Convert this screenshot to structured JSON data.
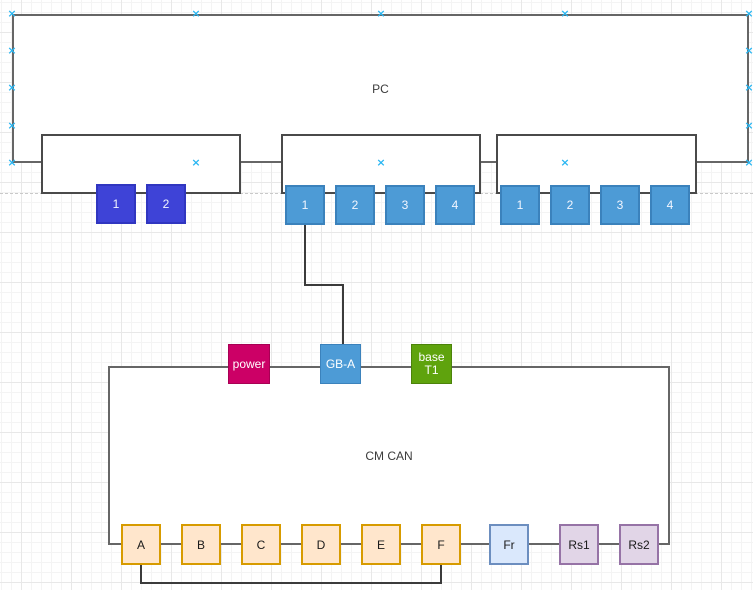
{
  "canvas": {
    "background_color": "#ffffff",
    "grid_minor_color": "#f4f4f4",
    "grid_major_color": "#e8e8e8",
    "page_break_color": "#c9c9c9",
    "connection_point_color": "#29b6f2",
    "connection_point_glyph": "×"
  },
  "pc_host": {
    "label": "PC",
    "border_color": "#666666",
    "nics": [
      {
        "name": "dual-port-nic",
        "port_fill": "#3e43d7",
        "port_border": "#3036c0",
        "ports": [
          "1",
          "2"
        ]
      },
      {
        "name": "quad-port-nic-1",
        "port_fill": "#4d9bd6",
        "port_border": "#3b82bc",
        "ports": [
          "1",
          "2",
          "3",
          "4"
        ]
      },
      {
        "name": "quad-port-nic-2",
        "port_fill": "#4d9bd6",
        "port_border": "#3b82bc",
        "ports": [
          "1",
          "2",
          "3",
          "4"
        ]
      }
    ]
  },
  "cm_device": {
    "label": "CM CAN",
    "border_color": "#666666",
    "top_modules": [
      {
        "label": "power",
        "fill": "#cc0066",
        "border": "#a80054"
      },
      {
        "label": "GB-A",
        "fill": "#4d9bd6",
        "border": "#3b82bc"
      },
      {
        "label_line1": "base",
        "label_line2": "T1",
        "fill": "#5fa30d",
        "border": "#4c830a"
      }
    ],
    "bottom_modules": [
      {
        "label": "A",
        "fill": "#ffe6cc",
        "border": "#d79b00"
      },
      {
        "label": "B",
        "fill": "#ffe6cc",
        "border": "#d79b00"
      },
      {
        "label": "C",
        "fill": "#ffe6cc",
        "border": "#d79b00"
      },
      {
        "label": "D",
        "fill": "#ffe6cc",
        "border": "#d79b00"
      },
      {
        "label": "E",
        "fill": "#ffe6cc",
        "border": "#d79b00"
      },
      {
        "label": "F",
        "fill": "#ffe6cc",
        "border": "#d79b00"
      },
      {
        "label": "Fr",
        "fill": "#dae8fc",
        "border": "#6c8ebf"
      },
      {
        "label": "Rs1",
        "fill": "#e1d5e7",
        "border": "#9673a6"
      },
      {
        "label": "Rs2",
        "fill": "#e1d5e7",
        "border": "#9673a6"
      }
    ]
  },
  "connectors": [
    {
      "name": "nic2-port1-to-gba",
      "color": "#3b3b3b"
    },
    {
      "name": "module-a-to-module-f",
      "color": "#3b3b3b"
    }
  ]
}
